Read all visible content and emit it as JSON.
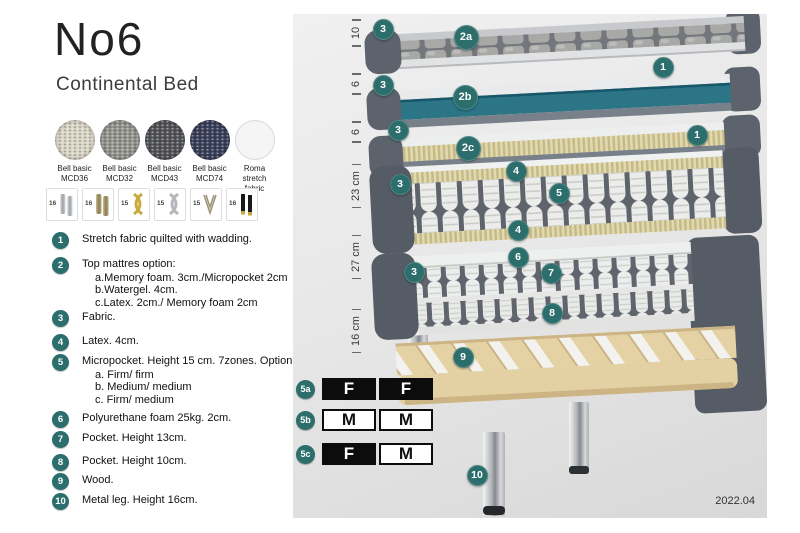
{
  "title": "No6",
  "subtitle": "Continental Bed",
  "version": "2022.04",
  "colors": {
    "callout_teal": "#2c6e6c",
    "watergel_teal": "#2b7587",
    "mattress_grey": "#5c636c",
    "latex_cream": "#e2daae",
    "wood": "#e4d1a3"
  },
  "swatches": [
    {
      "name": "Bell basic",
      "code": "MCD36",
      "color": "#d9d5c6",
      "plain": false
    },
    {
      "name": "Bell basic",
      "code": "MCD32",
      "color": "#95958f",
      "plain": false
    },
    {
      "name": "Bell basic",
      "code": "MCD43",
      "color": "#54555a",
      "plain": false
    },
    {
      "name": "Bell basic",
      "code": "MCD74",
      "color": "#3c415c",
      "plain": false
    },
    {
      "name": "Roma",
      "code": "stretch fabric",
      "color": "#f5f5f5",
      "plain": true
    }
  ],
  "leg_options": [
    {
      "height": "16",
      "style": "leg-cyl-silver"
    },
    {
      "height": "16",
      "style": "leg-cyl-brass"
    },
    {
      "height": "15",
      "style": "leg-twist-gold"
    },
    {
      "height": "15",
      "style": "leg-twist-silver"
    },
    {
      "height": "15",
      "style": "leg-hairpin"
    },
    {
      "height": "16",
      "style": "leg-black-gold"
    }
  ],
  "legend": [
    {
      "num": "1",
      "top": 232,
      "text": "Stretch fabric quilted with wadding.",
      "sub": []
    },
    {
      "num": "2",
      "top": 257,
      "text": "Top mattres option:",
      "sub": [
        "a.Memory foam. 3cm./Micropocket 2cm",
        "b.Watergel. 4cm.",
        "c.Latex. 2cm./ Memory foam 2cm"
      ]
    },
    {
      "num": "3",
      "top": 310,
      "text": "Fabric.",
      "sub": []
    },
    {
      "num": "4",
      "top": 334,
      "text": "Latex. 4cm.",
      "sub": []
    },
    {
      "num": "5",
      "top": 354,
      "text": "Micropocket. Height 15 cm. 7zones. Option:",
      "sub": [
        "a. Firm/ firm",
        "b. Medium/ medium",
        "c. Firm/ medium"
      ]
    },
    {
      "num": "6",
      "top": 411,
      "text": "Polyurethane foam 25kg. 2cm.",
      "sub": []
    },
    {
      "num": "7",
      "top": 431,
      "text": "Pocket. Height 13cm.",
      "sub": []
    },
    {
      "num": "8",
      "top": 454,
      "text": "Pocket. Height 10cm.",
      "sub": []
    },
    {
      "num": "9",
      "top": 473,
      "text": "Wood.",
      "sub": []
    },
    {
      "num": "10",
      "top": 493,
      "text": "Metal leg. Height 16cm.",
      "sub": []
    }
  ],
  "measurements": [
    {
      "label": "10",
      "y": 19
    },
    {
      "label": "6",
      "y": 70
    },
    {
      "label": "6",
      "y": 118
    },
    {
      "label": "23 cm",
      "y": 172
    },
    {
      "label": "27 cm",
      "y": 243
    },
    {
      "label": "16 cm",
      "y": 317
    }
  ],
  "diagram_badges": [
    {
      "label": "3",
      "x": 90,
      "y": 15,
      "size": 21
    },
    {
      "label": "2a",
      "x": 173,
      "y": 23,
      "size": 25
    },
    {
      "label": "1",
      "x": 370,
      "y": 53,
      "size": 21
    },
    {
      "label": "3",
      "x": 90,
      "y": 71,
      "size": 21
    },
    {
      "label": "2b",
      "x": 172,
      "y": 83,
      "size": 25
    },
    {
      "label": "3",
      "x": 105,
      "y": 116,
      "size": 21
    },
    {
      "label": "2c",
      "x": 175,
      "y": 134,
      "size": 25
    },
    {
      "label": "1",
      "x": 404,
      "y": 121,
      "size": 21
    },
    {
      "label": "3",
      "x": 107,
      "y": 170,
      "size": 21
    },
    {
      "label": "4",
      "x": 223,
      "y": 157,
      "size": 21
    },
    {
      "label": "5",
      "x": 266,
      "y": 179,
      "size": 21
    },
    {
      "label": "4",
      "x": 225,
      "y": 216,
      "size": 21
    },
    {
      "label": "6",
      "x": 225,
      "y": 243,
      "size": 21
    },
    {
      "label": "3",
      "x": 121,
      "y": 258,
      "size": 21
    },
    {
      "label": "7",
      "x": 258,
      "y": 259,
      "size": 21
    },
    {
      "label": "8",
      "x": 259,
      "y": 299,
      "size": 21
    },
    {
      "label": "9",
      "x": 170,
      "y": 343,
      "size": 21
    },
    {
      "label": "10",
      "x": 184,
      "y": 461,
      "size": 21
    }
  ],
  "firmness_options": [
    {
      "id": "5a",
      "top": 364,
      "cells": [
        {
          "letter": "F",
          "fill": "black"
        },
        {
          "letter": "F",
          "fill": "black"
        }
      ]
    },
    {
      "id": "5b",
      "top": 395,
      "cells": [
        {
          "letter": "M",
          "fill": "white"
        },
        {
          "letter": "M",
          "fill": "white"
        }
      ]
    },
    {
      "id": "5c",
      "top": 429,
      "cells": [
        {
          "letter": "F",
          "fill": "black"
        },
        {
          "letter": "M",
          "fill": "white"
        }
      ]
    }
  ]
}
